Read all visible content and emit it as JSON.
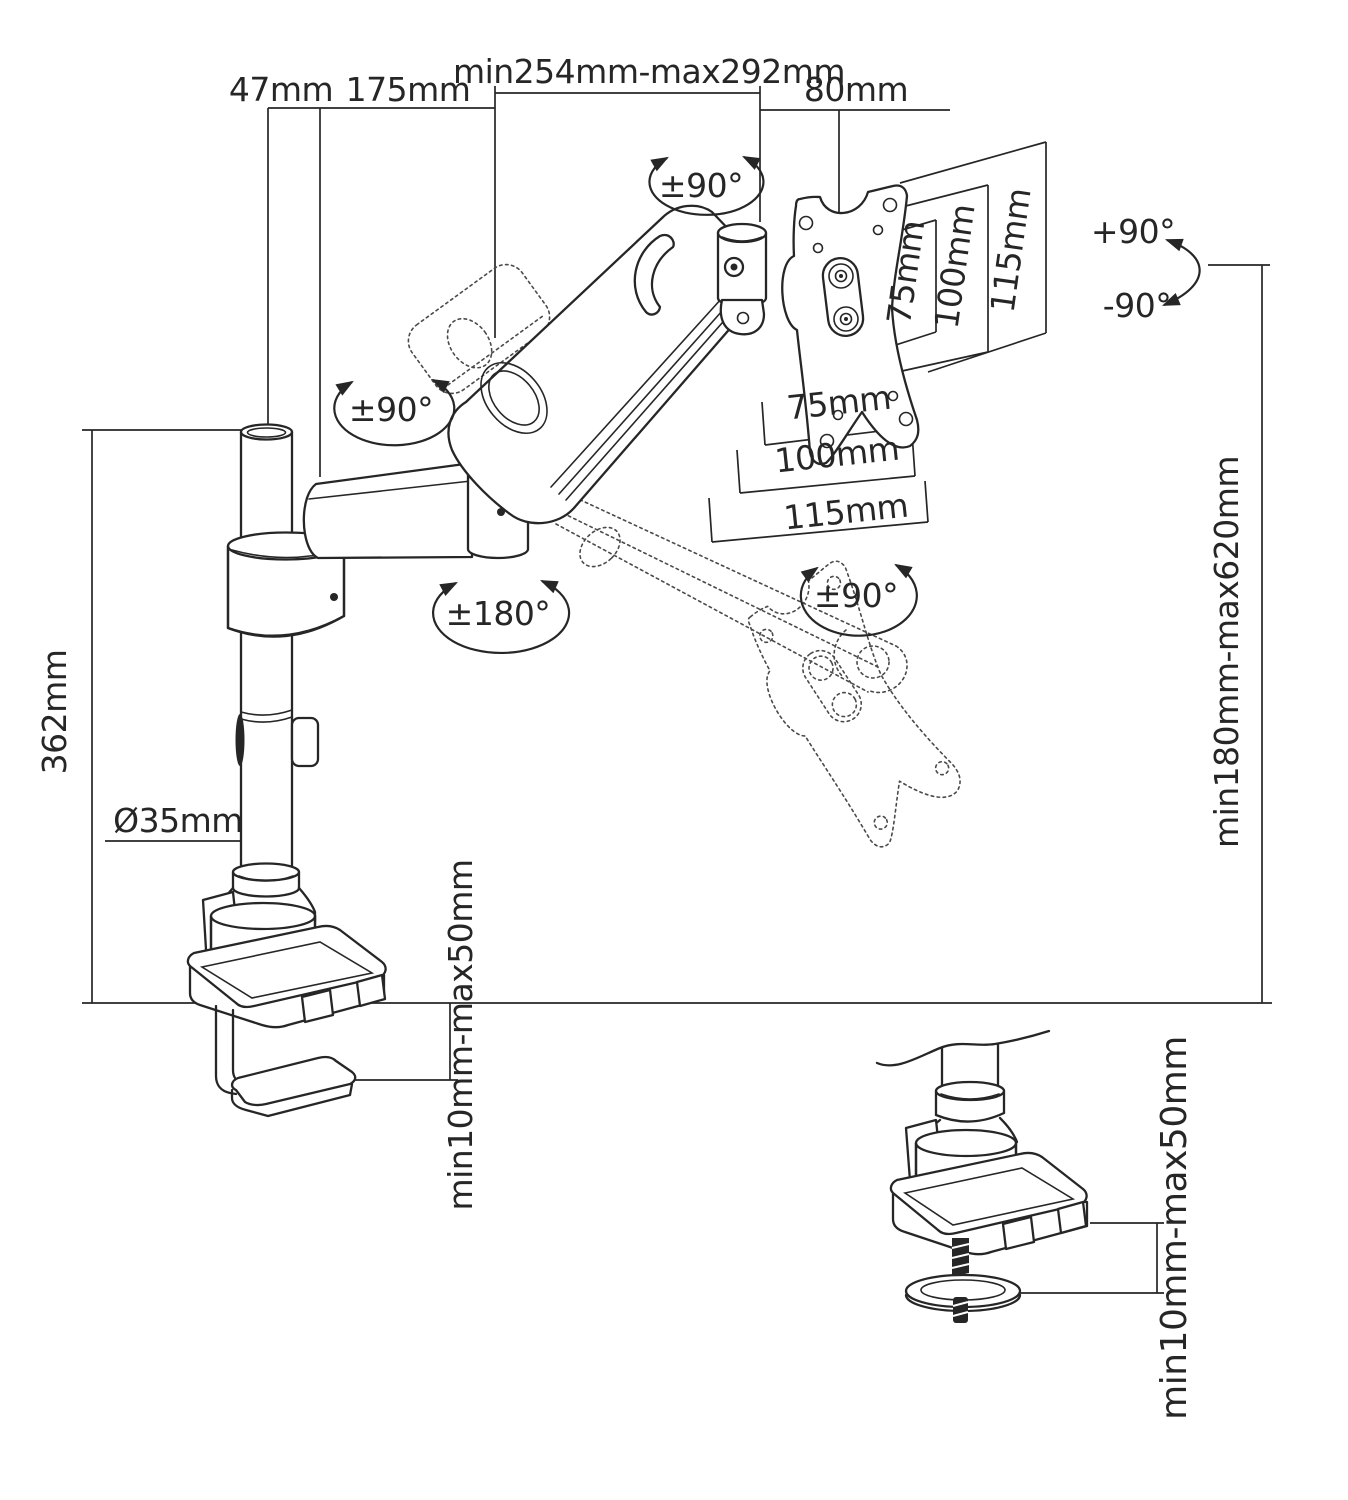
{
  "diagram_title": "monitor-arm-dimension-diagram",
  "dims": {
    "offset_47": "47mm",
    "arm1_175": "175mm",
    "reach_range": "min254mm-max292mm",
    "head_80": "80mm",
    "pole_height": "362mm",
    "pole_diameter": "Ø35mm",
    "height_range": "min180mm-max620mm",
    "clamp_thickness": "min10mm-max50mm",
    "grommet_thickness": "min10mm-max50mm",
    "vesa_side": {
      "v75": "75mm",
      "v100": "100mm",
      "v115": "115mm"
    },
    "vesa_bottom": {
      "h75": "75mm",
      "h100": "100mm",
      "h115": "115mm"
    }
  },
  "rotations": {
    "tilt_joint": "±90°",
    "pole_top": "±90°",
    "arm_swivel": "±180°",
    "vesa_rotation": "±90°",
    "screen_up": "+90°",
    "screen_down": "-90°"
  },
  "colors": {
    "line": "#262626",
    "background": "#ffffff"
  }
}
